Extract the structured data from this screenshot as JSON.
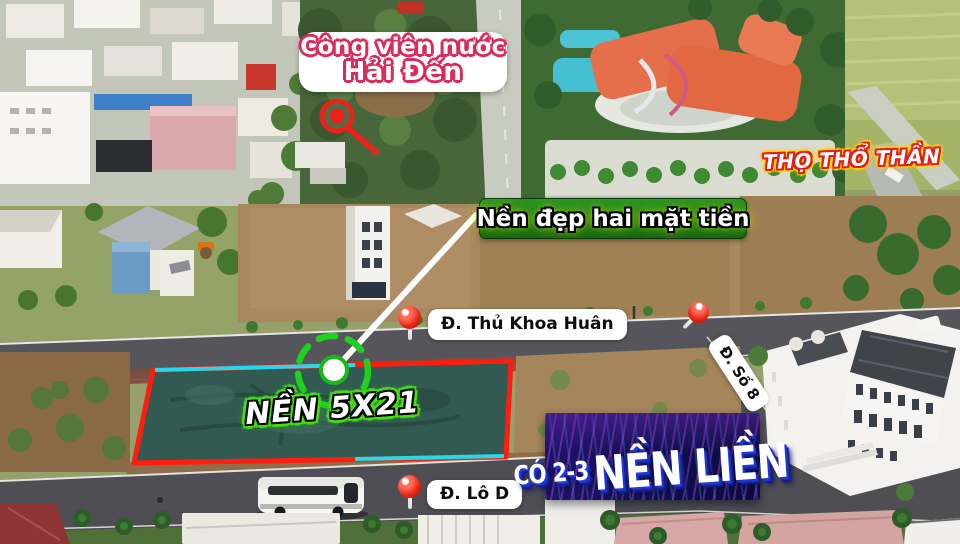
{
  "overlays": {
    "water_park_label": {
      "line1": "Công viên nước",
      "line2": "Hải Đến"
    },
    "agency_badge": {
      "text": "THỌ THỔ THẦN"
    },
    "feature_label": {
      "text": "Nền đẹp hai mặt tiền"
    },
    "street_label_1": {
      "text": "Đ. Thủ Khoa Huân"
    },
    "street_label_2": {
      "text": "Đ. Số 8"
    },
    "street_label_3": {
      "text": "Đ. Lô D"
    },
    "plot_size_label": {
      "text": "NỀN 5X21"
    },
    "banner": {
      "part1": "CÓ 2-3",
      "part2": "NỀN LIỀN"
    }
  },
  "icons": {
    "map_pin": "map-pin-icon",
    "location_magnifier": "magnifier-icon",
    "target_marker": "target-circle-icon"
  },
  "colors": {
    "plot_outline_red": "#ff1d0f",
    "plot_accent_cyan": "#25d8ea",
    "target_green": "#1fd11f",
    "pin_red": "#e22114",
    "waterpark_outline_pink": "#d92b5c",
    "badge_outline_red": "#e01f1f",
    "badge_glow_yellow": "#ffd400",
    "feature_label_green": "#1e8a1c",
    "size_label_green": "#44e112",
    "banner_navy": "#0d1150",
    "banner_shadow_blue": "#2238d8"
  }
}
